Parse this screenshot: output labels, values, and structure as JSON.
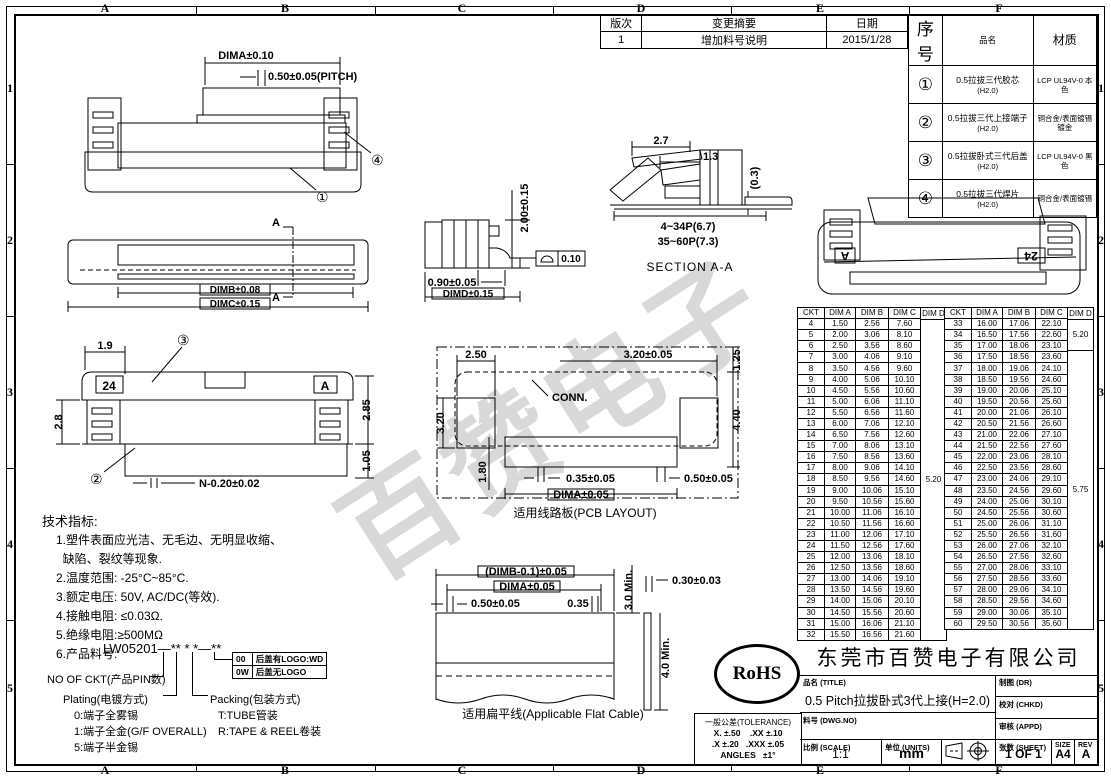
{
  "sheet": {
    "zones_cols": [
      "A",
      "B",
      "C",
      "D",
      "E",
      "F"
    ],
    "zones_rows": [
      "1",
      "2",
      "3",
      "4",
      "5"
    ]
  },
  "revision": {
    "headers": {
      "rev": "版次",
      "summary": "变更摘要",
      "date": "日期"
    },
    "rows": [
      [
        "1",
        "增加料号说明",
        "2015/1/28"
      ]
    ]
  },
  "bom": {
    "headers": {
      "no": "序号",
      "name": "品名",
      "material": "材质"
    },
    "rows": [
      {
        "no": "①",
        "name": "0.5拉拔三代胶芯",
        "sub": "(H2.0)",
        "material": "LCP UL94V-0 本色"
      },
      {
        "no": "②",
        "name": "0.5拉拔三代上接端子",
        "sub": "(H2.0)",
        "material": "铜合金/表面镀锡\n镀金"
      },
      {
        "no": "③",
        "name": "0.5拉拔卧式三代后盖",
        "sub": "(H2.0)",
        "material": "LCP UL94V-0 黑色"
      },
      {
        "no": "④",
        "name": "0.5拉拔三代焊片",
        "sub": "(H2.0)",
        "material": "铜合金/表面镀锡"
      }
    ]
  },
  "dim_table": {
    "headers": [
      "CKT",
      "DIM A",
      "DIM B",
      "DIM C",
      "DIM D"
    ],
    "left_rows": [
      [
        "4",
        "1.50",
        "2.56",
        "7.60"
      ],
      [
        "5",
        "2.00",
        "3.06",
        "8.10"
      ],
      [
        "6",
        "2.50",
        "3.56",
        "8.60"
      ],
      [
        "7",
        "3.00",
        "4.06",
        "9.10"
      ],
      [
        "8",
        "3.50",
        "4.56",
        "9.60"
      ],
      [
        "9",
        "4.00",
        "5.06",
        "10.10"
      ],
      [
        "10",
        "4.50",
        "5.56",
        "10.60"
      ],
      [
        "11",
        "5.00",
        "6.06",
        "11.10"
      ],
      [
        "12",
        "5.50",
        "6.56",
        "11.60"
      ],
      [
        "13",
        "6.00",
        "7.06",
        "12.10"
      ],
      [
        "14",
        "6.50",
        "7.56",
        "12.60"
      ],
      [
        "15",
        "7.00",
        "8.06",
        "13.10"
      ],
      [
        "16",
        "7.50",
        "8.56",
        "13.60"
      ],
      [
        "17",
        "8.00",
        "9.06",
        "14.10"
      ],
      [
        "18",
        "8.50",
        "9.56",
        "14.60"
      ],
      [
        "19",
        "9.00",
        "10.06",
        "15.10"
      ],
      [
        "20",
        "9.50",
        "10.56",
        "15.60"
      ],
      [
        "21",
        "10.00",
        "11.06",
        "16.10"
      ],
      [
        "22",
        "10.50",
        "11.56",
        "16.60"
      ],
      [
        "23",
        "11.00",
        "12.06",
        "17.10"
      ],
      [
        "24",
        "11.50",
        "12.56",
        "17.60"
      ],
      [
        "25",
        "12.00",
        "13.06",
        "18.10"
      ],
      [
        "26",
        "12.50",
        "13.56",
        "18.60"
      ],
      [
        "27",
        "13.00",
        "14.06",
        "19.10"
      ],
      [
        "28",
        "13.50",
        "14.56",
        "19.60"
      ],
      [
        "29",
        "14.00",
        "15.06",
        "20.10"
      ],
      [
        "30",
        "14.50",
        "15.56",
        "20.60"
      ],
      [
        "31",
        "15.00",
        "16.06",
        "21.10"
      ],
      [
        "32",
        "15.50",
        "16.56",
        "21.60"
      ]
    ],
    "left_dimd": [
      {
        "label": "5.20",
        "grow": 29
      }
    ],
    "right_rows": [
      [
        "33",
        "16.00",
        "17.06",
        "22.10"
      ],
      [
        "34",
        "16.50",
        "17.56",
        "22.60"
      ],
      [
        "35",
        "17.00",
        "18.06",
        "23.10"
      ],
      [
        "36",
        "17.50",
        "18.56",
        "23.60"
      ],
      [
        "37",
        "18.00",
        "19.06",
        "24.10"
      ],
      [
        "38",
        "18.50",
        "19.56",
        "24.60"
      ],
      [
        "39",
        "19.00",
        "20.06",
        "25.10"
      ],
      [
        "40",
        "19.50",
        "20.56",
        "25.60"
      ],
      [
        "41",
        "20.00",
        "21.06",
        "26.10"
      ],
      [
        "42",
        "20.50",
        "21.56",
        "26.60"
      ],
      [
        "43",
        "21.00",
        "22.06",
        "27.10"
      ],
      [
        "44",
        "21.50",
        "22.56",
        "27.60"
      ],
      [
        "45",
        "22.00",
        "23.06",
        "28.10"
      ],
      [
        "46",
        "22.50",
        "23.56",
        "28.60"
      ],
      [
        "47",
        "23.00",
        "24.06",
        "29.10"
      ],
      [
        "48",
        "23.50",
        "24.56",
        "29.60"
      ],
      [
        "49",
        "24.00",
        "25.06",
        "30.10"
      ],
      [
        "50",
        "24.50",
        "25.56",
        "30.60"
      ],
      [
        "51",
        "25.00",
        "26.06",
        "31.10"
      ],
      [
        "52",
        "25.50",
        "26.56",
        "31.60"
      ],
      [
        "53",
        "26.00",
        "27.06",
        "32.10"
      ],
      [
        "54",
        "26.50",
        "27.56",
        "32.60"
      ],
      [
        "55",
        "27.00",
        "28.06",
        "33.10"
      ],
      [
        "56",
        "27.50",
        "28.56",
        "33.60"
      ],
      [
        "57",
        "28.00",
        "29.06",
        "34.10"
      ],
      [
        "58",
        "28.50",
        "29.56",
        "34.60"
      ],
      [
        "59",
        "29.00",
        "30.06",
        "35.10"
      ],
      [
        "60",
        "29.50",
        "30.56",
        "35.60"
      ]
    ],
    "right_dimd": [
      {
        "label": "5.20",
        "grow": 2
      },
      {
        "label": "5.75",
        "grow": 26
      }
    ]
  },
  "notes": {
    "title": "技术指标:",
    "items": [
      "1.塑件表面应光洁、无毛边、无明显收缩、",
      "  缺陷、裂纹等现象.",
      "2.温度范围: -25°C~85°C.",
      "3.额定电压: 50V, AC/DC(等效).",
      "4.接触电阻: ≤0.03Ω.",
      "5.绝缘电阻:≥500MΩ",
      "6.产品料号:"
    ]
  },
  "part_number": {
    "code": "LW05201",
    "mask": "—** * *—**",
    "ckt_label": "NO OF CKT(产品PIN数)",
    "plating_label": "Plating(电镀方式)",
    "plating_options": "0:端子全雾锡\n1:端子全金(G/F OVERALL)\n5:端子半金锡",
    "packing_label": "Packing(包装方式)",
    "packing_options": "T:TUBE管装\nR:TAPE & REEL卷装",
    "logo_options": [
      {
        "code": "00",
        "desc": "后盖有LOGO:WD"
      },
      {
        "code": "0W",
        "desc": "后盖无LOGO"
      }
    ]
  },
  "tolerance": {
    "title": "一般公差(TOLERANCE)",
    "l1": "X. ±.50    .XX ±.10",
    "l2": ".X ±.20   .XXX ±.05",
    "l3": "ANGLES   ±1°"
  },
  "rohs": "RoHS",
  "watermark": "百赞电子",
  "title_block": {
    "company": "东莞市百赞电子有限公司",
    "title_label": "品名 (TITLE)",
    "title_value": "0.5 Pitch拉拔卧式3代上接(H=2.0)",
    "dwgno_label": "料号 (DWG.NO)",
    "dr_label": "制图 (DR)",
    "chkd_label": "校对 (CHKD)",
    "appd_label": "审核 (APPD)",
    "scale_label": "比例 (SCALE)",
    "scale_value": "1:1",
    "units_label": "单位 (UNITS)",
    "units_value": "mm",
    "sheet_label": "张数 (SHEET)",
    "sheet_value": "1 OF 1",
    "size_label": "SIZE",
    "size_value": "A4",
    "rev_label": "REV",
    "rev_value": "A"
  },
  "drawings": {
    "front": {
      "dima": "DIMA±0.10",
      "pitch": "0.50±0.05(PITCH)",
      "balloon_body": "①",
      "balloon_fitting": "④"
    },
    "top": {
      "dimb": "DIMB±0.08",
      "dimc": "DIMC±0.15",
      "section_letter": "A"
    },
    "bottom": {
      "w19": "1.9",
      "h28": "2.8",
      "h285": "2.85",
      "h105": "1.05",
      "pins": "N-0.20±0.02",
      "mark24": "24",
      "marka": "A",
      "balloon_terminal": "②",
      "balloon_cover": "③"
    },
    "side": {
      "h200": "2.00±0.15",
      "w090": "0.90±0.05",
      "dimd": "DIMD±0.15",
      "flatness": "0.10"
    },
    "section": {
      "w27": "2.7",
      "w13": "1.3",
      "t03": "(0.3)",
      "p1": "4~34P(6.7)",
      "p2": "35~60P(7.3)",
      "label": "SECTION A-A"
    },
    "iso": {
      "mark24": "24",
      "marka": "A"
    },
    "pcb": {
      "w250": "2.50",
      "w320": "3.20±0.05",
      "h125": "1.25",
      "h320": "3.20",
      "h440": "4.40",
      "h180": "1.80",
      "w035": "0.35±0.05",
      "w050": "0.50±0.05",
      "dima": "DIMA±0.05",
      "conn": "CONN.",
      "caption": "适用线路板(PCB LAYOUT)"
    },
    "cable": {
      "dimb": "(DIMB-0.1)±0.05",
      "dima": "DIMA±0.05",
      "w050": "0.50±0.05",
      "w035": "0.35",
      "min3": "3.0 Min.",
      "t030": "0.30±0.03",
      "min4": "4.0 Min.",
      "caption": "适用扁平线(Applicable Flat Cable)"
    }
  }
}
